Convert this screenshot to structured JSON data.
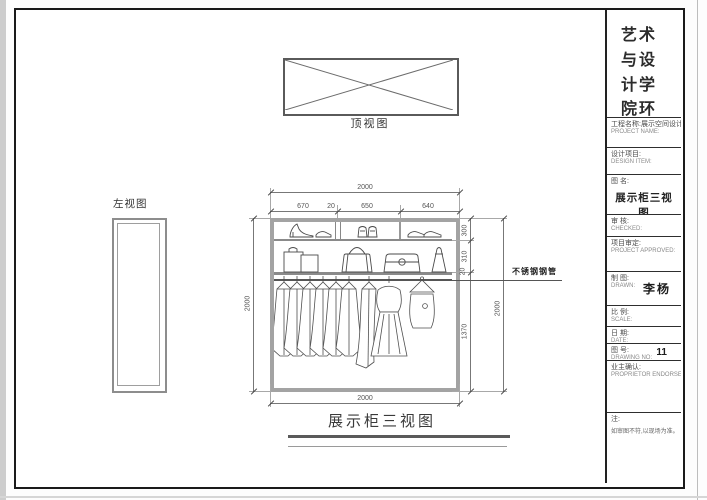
{
  "sheet": {
    "school_title": "艺术与设计学院环境设计",
    "class_name": "11001班"
  },
  "views": {
    "top": {
      "label": "顶视图"
    },
    "left": {
      "label": "左视图"
    },
    "front": {
      "caption": "展示柜三视图"
    }
  },
  "dimensions": {
    "top_overall": "2000",
    "top_segments": [
      "670",
      "20",
      "650",
      "640"
    ],
    "left_height": "2000",
    "right_segments": [
      "300",
      "310",
      "20",
      "1370"
    ],
    "right_overall": "2000",
    "bottom_width": "2000"
  },
  "annotations": {
    "rod_label": "不锈钢钢管"
  },
  "title_block": {
    "project_name_cn": "工程名称:展示空间设计",
    "project_name_en": "PROJECT NAME:",
    "design_item_cn": "设计项目:",
    "design_item_en": "DESIGN ITEM:",
    "drawing_name_label": "图  名:",
    "drawing_name_value": "展示柜三视图",
    "checked_cn": "审  核:",
    "checked_en": "CHECKED:",
    "approved_cn": "项目审定:",
    "approved_en": "PROJECT APPROVED:",
    "drawn_cn": "制  图:",
    "drawn_en": "DRAWN:",
    "drawn_value": "李杨",
    "scale_cn": "比  例:",
    "scale_en": "SCALE:",
    "date_cn": "日  期:",
    "date_en": "DATE:",
    "drawing_no_cn": "图  号:",
    "drawing_no_en": "DRAWING NO:",
    "drawing_no_value": "11",
    "proprietor_cn": "业主确认:",
    "proprietor_en": "PROPRIETOR ENDORSE:",
    "note_label": "注:",
    "note_text": "如审图不符,以现场为准。"
  }
}
